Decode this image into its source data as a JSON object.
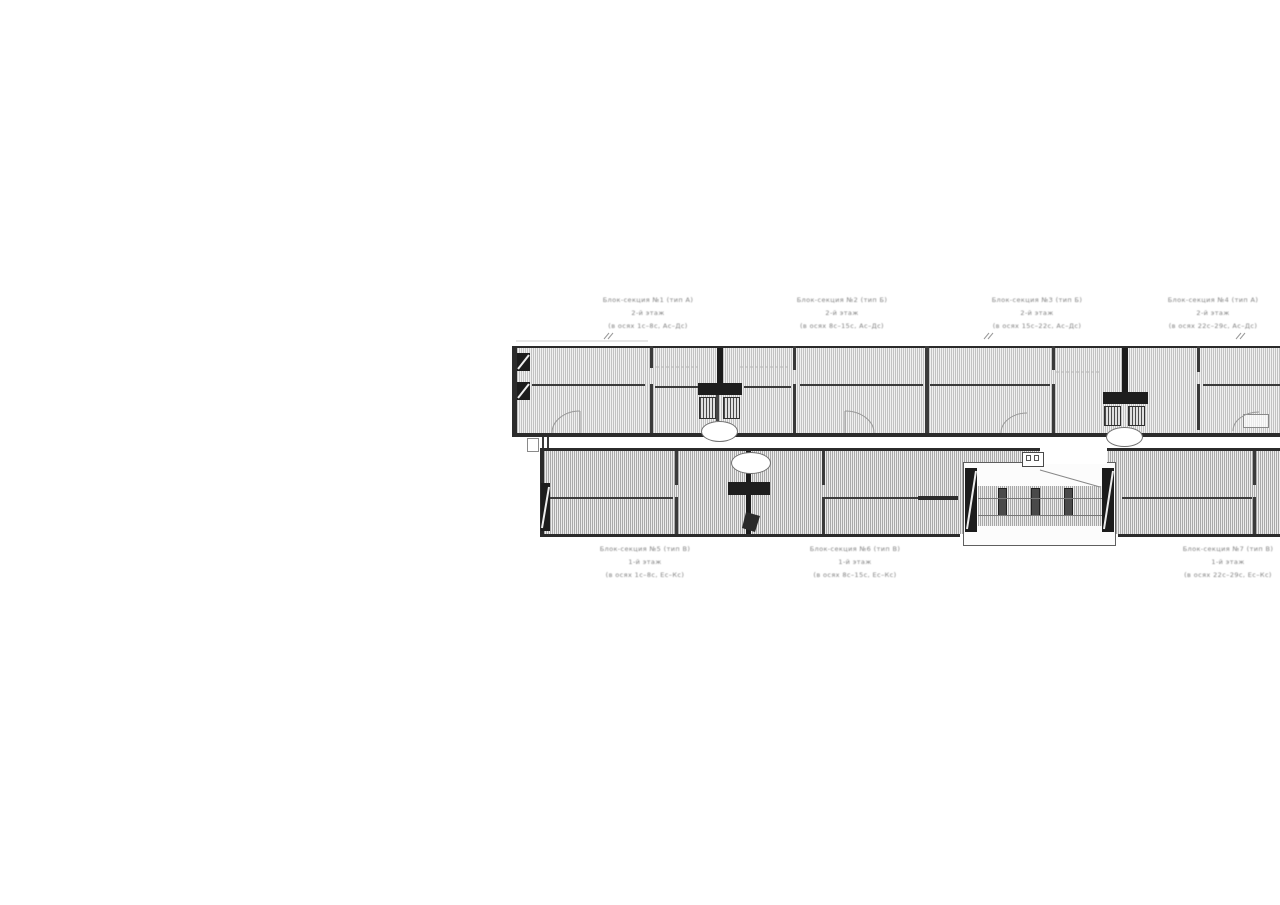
{
  "page": {
    "background": "#ffffff",
    "description": "Scanned architectural floor plan — two long parallel building wings with hatched rooms, stair cores and section labels"
  },
  "colors": {
    "outer_wall": "#2b2b2b",
    "partition_wall": "#3a3a3a",
    "hatch_dark": "#b5b5b5",
    "hatch_light": "#f1f1f1",
    "label_text": "#808080",
    "door_arc": "#999999"
  },
  "labels": {
    "top": [
      {
        "line1": "Блок-секция №1 (тип А)",
        "line2": "2-й этаж",
        "line3": "(в осях 1с–8с, Ас–Дс)"
      },
      {
        "line1": "Блок-секция №2 (тип Б)",
        "line2": "2-й этаж",
        "line3": "(в осях 8с–15с, Ас–Дс)"
      },
      {
        "line1": "Блок-секция №3 (тип Б)",
        "line2": "2-й этаж",
        "line3": "(в осях 15с–22с, Ас–Дс)"
      },
      {
        "line1": "Блок-секция №4 (тип А)",
        "line2": "2-й этаж",
        "line3": "(в осях 22с–29с, Ас–Дс)"
      }
    ],
    "bottom": [
      {
        "line1": "Блок-секция №5 (тип В)",
        "line2": "1-й этаж",
        "line3": "(в осях 1с–8с, Ес–Кс)"
      },
      {
        "line1": "Блок-секция №6 (тип В)",
        "line2": "1-й этаж",
        "line3": "(в осях 8с–15с, Ес–Кс)"
      },
      {
        "line1": "Блок-секция №7 (тип В)",
        "line2": "1-й этаж",
        "line3": "(в осях 22с–29с, Ес–Кс)"
      }
    ]
  }
}
